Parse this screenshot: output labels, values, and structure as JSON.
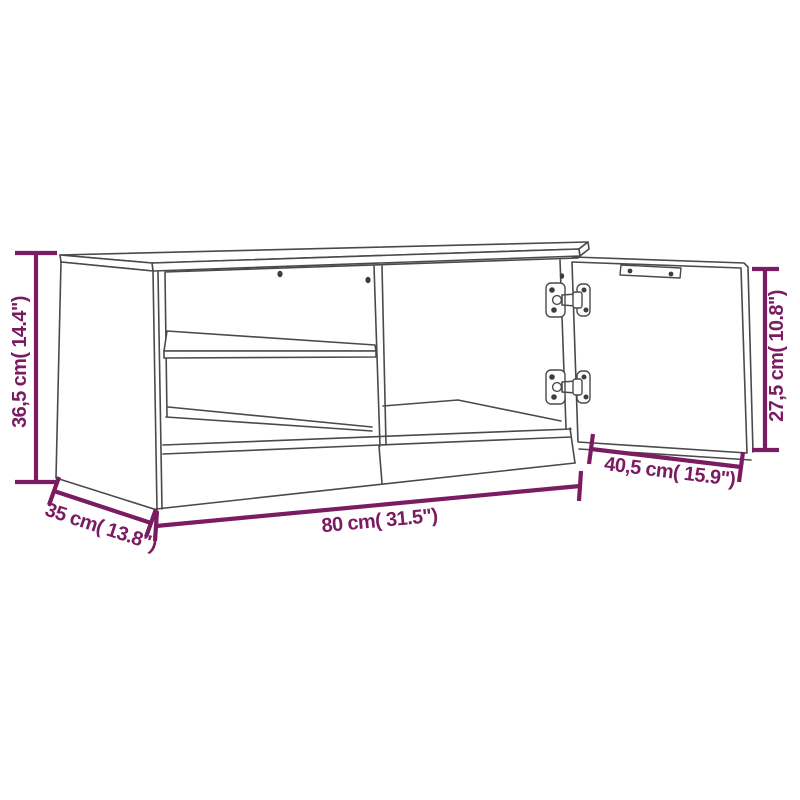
{
  "colors": {
    "dimension_accent": "#7b1c62",
    "drawing_line": "#4a4a4a",
    "background": "#ffffff"
  },
  "diagram": {
    "subject": "TV cabinet line drawing: left compartment with middle shelf, right door open on two cup hinges, dimension lines",
    "dimensions": {
      "height": {
        "label": "36,5 cm( 14.4\")",
        "cm": "36,5",
        "inch": "14.4"
      },
      "width": {
        "label": "80 cm( 31.5\")",
        "cm": "80",
        "inch": "31.5"
      },
      "depth": {
        "label": "35 cm( 13.8\")",
        "cm": "35",
        "inch": "13.8"
      },
      "door_width": {
        "label": "40,5 cm( 15.9\")",
        "cm": "40,5",
        "inch": "15.9"
      },
      "door_height": {
        "label": "27,5 cm( 10.8\")",
        "cm": "27,5",
        "inch": "10.8"
      }
    }
  }
}
